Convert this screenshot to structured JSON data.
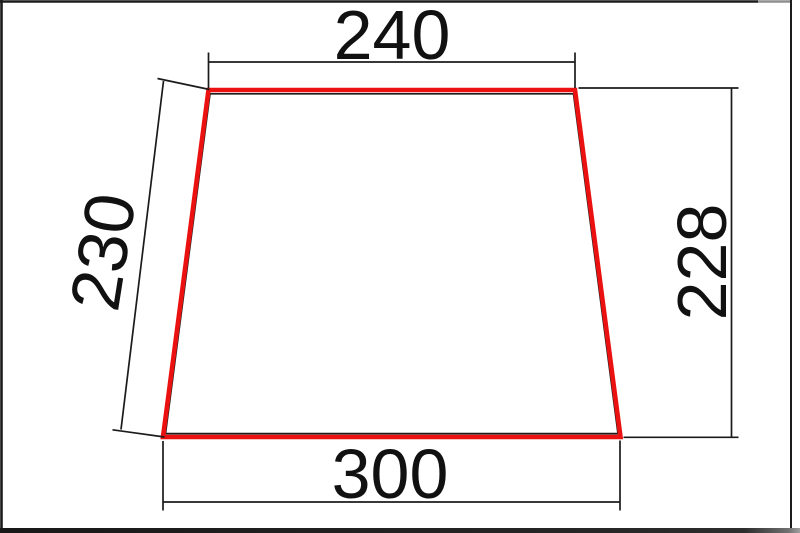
{
  "drawing": {
    "title": "trapezoid-dimension-drawing",
    "shape": "trapezoid",
    "dimensions": {
      "top_width": "240",
      "bottom_width": "300",
      "left_side": "230",
      "right_height": "228"
    },
    "colors": {
      "highlight_red": "#ec1111",
      "line_black": "#1b1b1b",
      "text_black": "#111111"
    }
  }
}
